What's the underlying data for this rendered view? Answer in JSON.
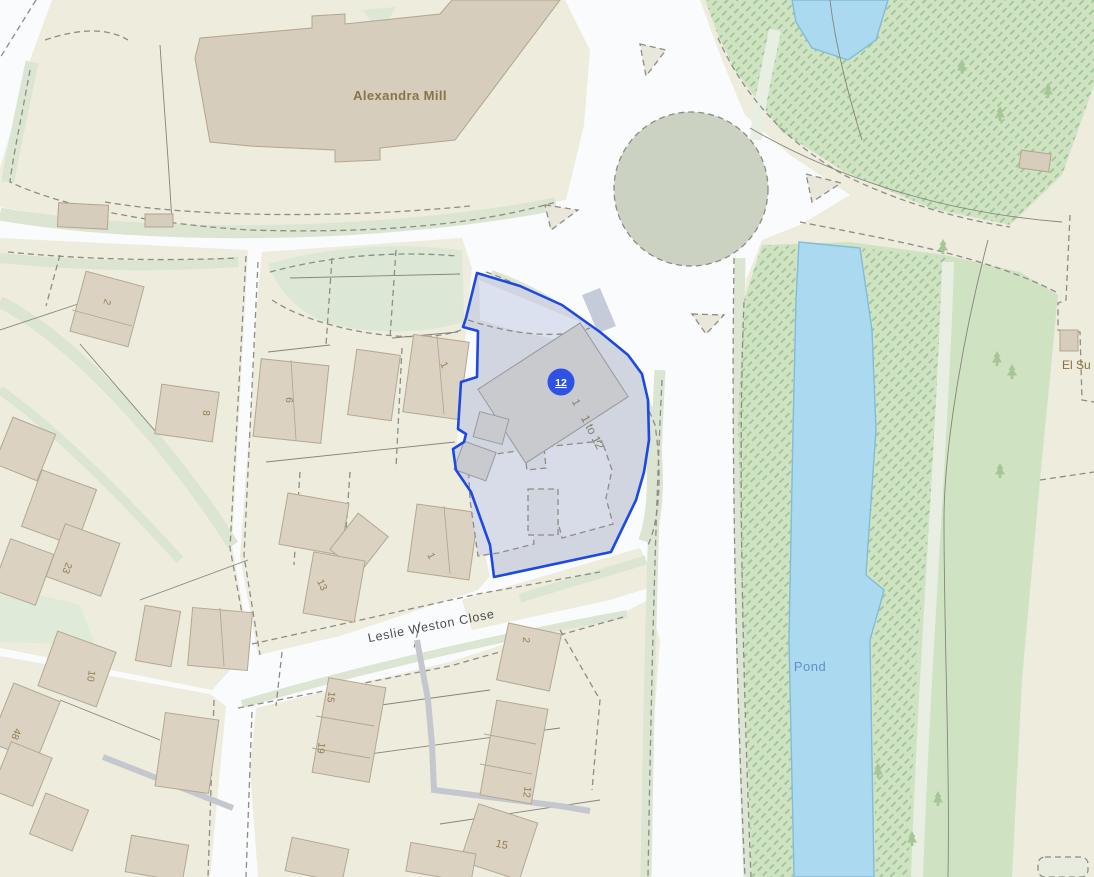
{
  "map": {
    "place_labels": {
      "mill": "Alexandra Mill",
      "street": "Leslie Weston Close",
      "pond": "Pond",
      "substation": "El Su"
    },
    "selected_parcel": {
      "marker_value": "12",
      "building_number": "1",
      "building_range": "1 to 12",
      "outline_color": "#1d49e2",
      "marker_color": "#2d52e4",
      "fill_color": "#d1d5e0"
    },
    "house_numbers": [
      {
        "text": "2"
      },
      {
        "text": "8"
      },
      {
        "text": "6"
      },
      {
        "text": "1"
      },
      {
        "text": "23"
      },
      {
        "text": "13"
      },
      {
        "text": "1"
      },
      {
        "text": "2"
      },
      {
        "text": "10"
      },
      {
        "text": "48"
      },
      {
        "text": "15"
      },
      {
        "text": "19"
      },
      {
        "text": "12"
      },
      {
        "text": "15"
      }
    ],
    "colors": {
      "road": "#ffffff",
      "parcel_land": "#edecdd",
      "residential_building": "#dbd2c2",
      "mill_building": "#d7cdbc",
      "grey_building": "#c9cacd",
      "green_verge": "#dbe5d2",
      "woodland": "#cfe3c3",
      "water": "#abd9f0",
      "water_label": "#6090c8",
      "number_label": "#8f7e52",
      "street_label": "#4c4c4c",
      "roundabout_island": "#ccd2c1"
    }
  }
}
